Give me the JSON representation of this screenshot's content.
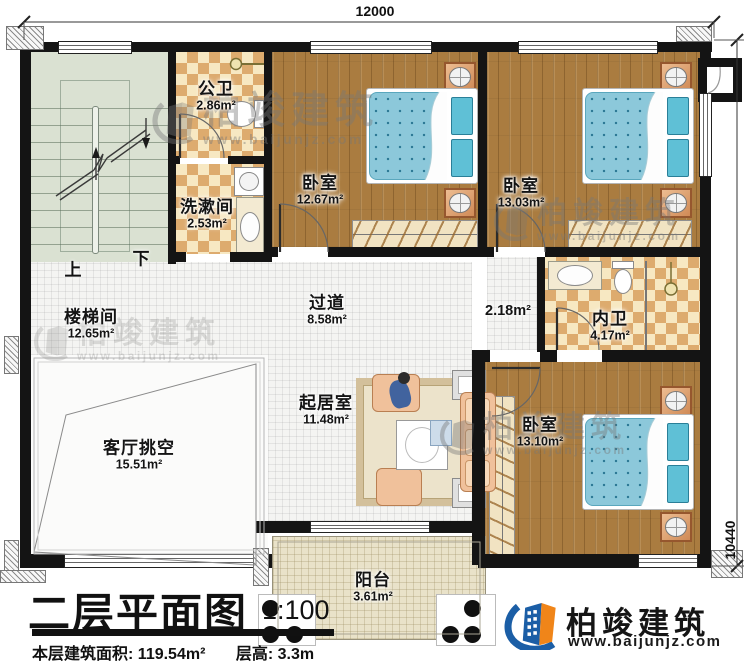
{
  "plan": {
    "dim_top": "12000",
    "dim_right": "10440",
    "stairs_up": "上",
    "stairs_down": "下"
  },
  "rooms": [
    {
      "id": "stair-hall",
      "name": "楼梯间",
      "area": "12.65m²"
    },
    {
      "id": "public-bath",
      "name": "公卫",
      "area": "2.86m²"
    },
    {
      "id": "washroom",
      "name": "洗漱间",
      "area": "2.53m²"
    },
    {
      "id": "bedroom-top-left",
      "name": "卧室",
      "area": "12.67m²"
    },
    {
      "id": "bedroom-top-right",
      "name": "卧室",
      "area": "13.03m²"
    },
    {
      "id": "hallway",
      "name": "过道",
      "area": "8.58m²"
    },
    {
      "id": "nook",
      "name": "",
      "area": "2.18m²"
    },
    {
      "id": "ensuite-bath",
      "name": "内卫",
      "area": "4.17m²"
    },
    {
      "id": "living-void",
      "name": "客厅挑空",
      "area": "15.51m²"
    },
    {
      "id": "sitting-room",
      "name": "起居室",
      "area": "11.48m²"
    },
    {
      "id": "bedroom-bottom",
      "name": "卧室",
      "area": "13.10m²"
    },
    {
      "id": "balcony",
      "name": "阳台",
      "area": "3.61m²"
    }
  ],
  "title": {
    "text": "二层平面图",
    "scale": "1:100",
    "area_label": "本层建筑面积:",
    "area_value": "119.54m²",
    "height_label": "层高:",
    "height_value": "3.3m"
  },
  "brand": {
    "name": "柏竣建筑",
    "website": "www.baijunjz.com",
    "blue": "#1b5ea6",
    "orange": "#f08519"
  },
  "watermark": {
    "name": "柏竣建筑",
    "website": "www.baijunjz.com"
  }
}
